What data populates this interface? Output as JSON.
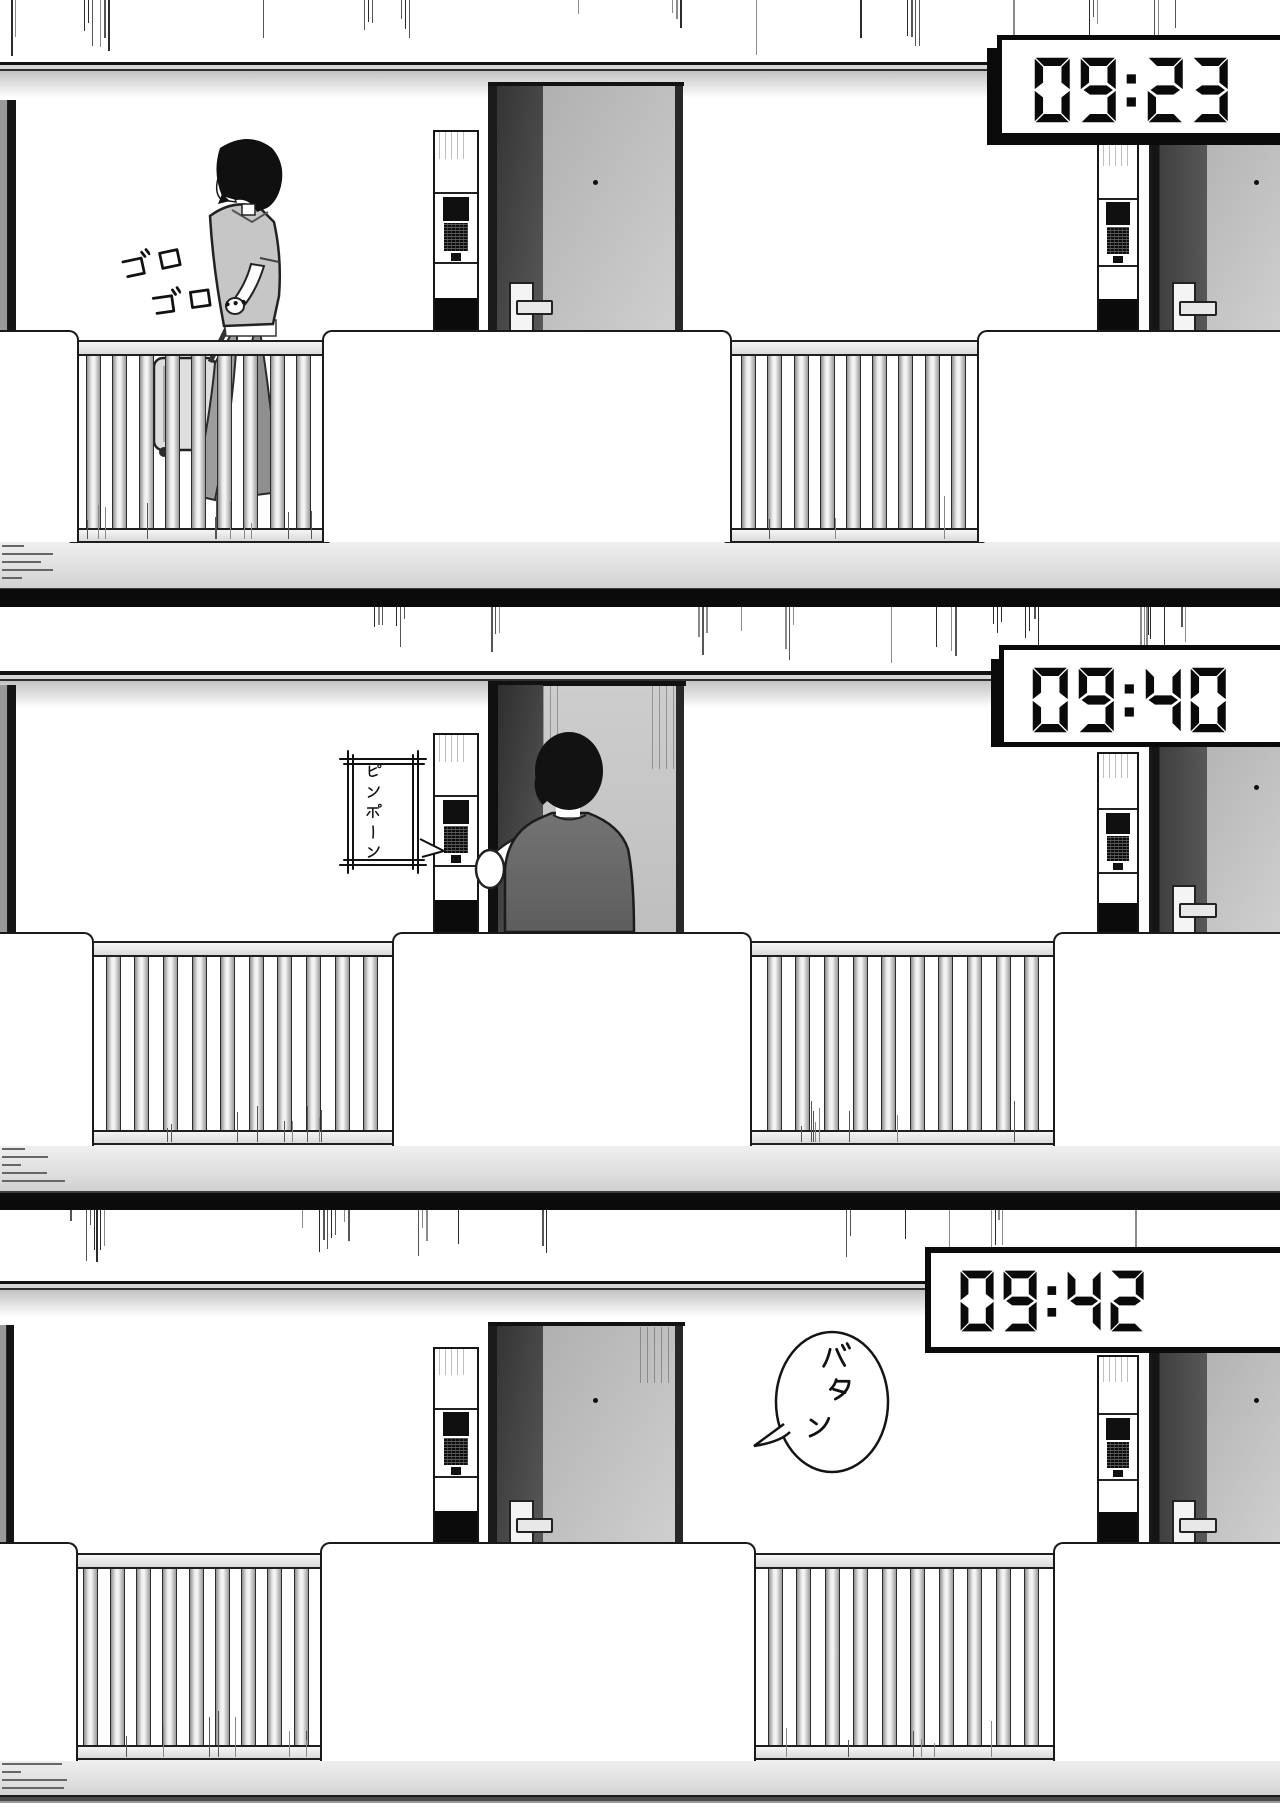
{
  "page": {
    "type": "manga-comic-page",
    "panel_count": 3,
    "setting": "apartment exterior corridor with doors and railing",
    "colors": {
      "line_ink": "#111111",
      "clock_face": "#ffffff",
      "clock_frame": "#0a0a0a",
      "door_dark": "#3a3a3a",
      "door_light": "#c2c2c2",
      "railing": "#ededed",
      "separator": "#0b0b0b"
    }
  },
  "panels": [
    {
      "name": "panel-1",
      "clock": {
        "time": "09:23"
      },
      "sfx": {
        "suitcase_rolling": "ゴロゴロ…"
      }
    },
    {
      "name": "panel-2",
      "clock": {
        "time": "09:40"
      },
      "sfx": {
        "doorbell": "ピンポーン"
      }
    },
    {
      "name": "panel-3",
      "clock": {
        "time": "09:42"
      },
      "sfx": {
        "door_slam": "バタン"
      }
    }
  ]
}
